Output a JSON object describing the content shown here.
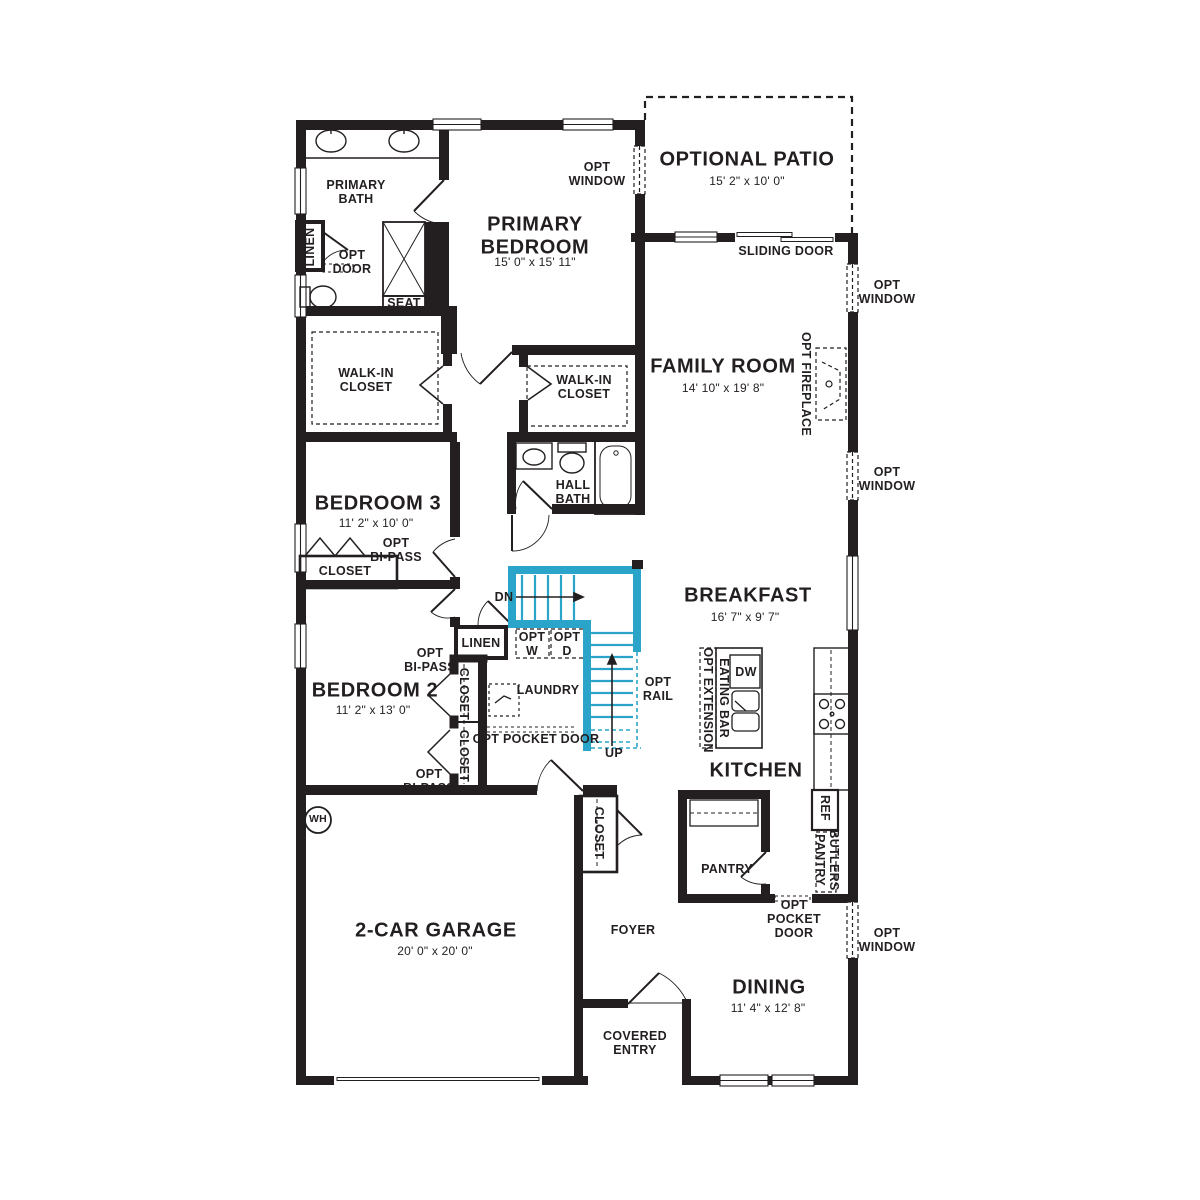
{
  "plan": {
    "title": "First floor residential floor plan",
    "colors": {
      "wall": "#231f20",
      "stairs_accent": "#2aa5c9",
      "background": "#ffffff"
    },
    "fixtures": [
      "double-vanity-sinks",
      "toilet",
      "shower-with-seat",
      "linen-cabinet",
      "bathtub",
      "vanity-sink",
      "walk-in-closet-shelving",
      "washer-optional",
      "dryer-optional",
      "laundry-sink",
      "kitchen-island",
      "dishwasher",
      "double-basin-sink",
      "range-burners",
      "refrigerator",
      "butlers-pantry-counter",
      "pantry-shelf",
      "fireplace-optional",
      "water-heater",
      "stairs-up",
      "stairs-down",
      "garage-door",
      "sliding-glass-door",
      "front-door"
    ],
    "labels": [
      {
        "id": "primary-bath",
        "lines": [
          "PRIMARY",
          "BATH"
        ],
        "x": 356,
        "y": 192,
        "cls": "sub"
      },
      {
        "id": "linen-bath",
        "lines": [
          "LINEN"
        ],
        "x": 310,
        "y": 247,
        "cls": "sub",
        "rot": -90
      },
      {
        "id": "opt-door",
        "lines": [
          "OPT",
          "DOOR"
        ],
        "x": 352,
        "y": 262,
        "cls": "sub"
      },
      {
        "id": "seat",
        "lines": [
          "SEAT"
        ],
        "x": 404,
        "y": 303,
        "cls": "sub"
      },
      {
        "id": "primary-bedroom-name",
        "lines": [
          "PRIMARY",
          "BEDROOM"
        ],
        "x": 535,
        "y": 236,
        "cls": "room"
      },
      {
        "id": "primary-bedroom-dims",
        "lines": [
          "15' 0\" x 15' 11\""
        ],
        "x": 535,
        "y": 263,
        "cls": "dim"
      },
      {
        "id": "opt-window-top",
        "lines": [
          "OPT",
          "WINDOW"
        ],
        "x": 597,
        "y": 174,
        "cls": "sub"
      },
      {
        "id": "optional-patio-name",
        "lines": [
          "OPTIONAL PATIO"
        ],
        "x": 747,
        "y": 160,
        "cls": "room"
      },
      {
        "id": "optional-patio-dims",
        "lines": [
          "15' 2\" x 10' 0\""
        ],
        "x": 747,
        "y": 182,
        "cls": "dim"
      },
      {
        "id": "sliding-door",
        "lines": [
          "SLIDING DOOR"
        ],
        "x": 786,
        "y": 251,
        "cls": "sub"
      },
      {
        "id": "opt-window-right-1",
        "lines": [
          "OPT",
          "WINDOW"
        ],
        "x": 887,
        "y": 292,
        "cls": "sub"
      },
      {
        "id": "family-room-name",
        "lines": [
          "FAMILY ROOM"
        ],
        "x": 723,
        "y": 367,
        "cls": "room"
      },
      {
        "id": "family-room-dims",
        "lines": [
          "14' 10\" x 19' 8\""
        ],
        "x": 723,
        "y": 389,
        "cls": "dim"
      },
      {
        "id": "opt-fireplace",
        "lines": [
          "OPT FIREPLACE"
        ],
        "x": 806,
        "y": 384,
        "cls": "sub",
        "rot": 90
      },
      {
        "id": "opt-window-right-2",
        "lines": [
          "OPT",
          "WINDOW"
        ],
        "x": 887,
        "y": 479,
        "cls": "sub"
      },
      {
        "id": "walk-in-closet-left",
        "lines": [
          "WALK-IN",
          "CLOSET"
        ],
        "x": 366,
        "y": 380,
        "cls": "sub"
      },
      {
        "id": "walk-in-closet-right",
        "lines": [
          "WALK-IN",
          "CLOSET"
        ],
        "x": 584,
        "y": 387,
        "cls": "sub"
      },
      {
        "id": "hall-bath",
        "lines": [
          "HALL",
          "BATH"
        ],
        "x": 573,
        "y": 492,
        "cls": "sub"
      },
      {
        "id": "bedroom3-name",
        "lines": [
          "BEDROOM 3"
        ],
        "x": 378,
        "y": 504,
        "cls": "room"
      },
      {
        "id": "bedroom3-dims",
        "lines": [
          "11' 2\" x 10' 0\""
        ],
        "x": 376,
        "y": 524,
        "cls": "dim"
      },
      {
        "id": "opt-bipass-bedroom3",
        "lines": [
          "OPT",
          "BI-PASS"
        ],
        "x": 396,
        "y": 550,
        "cls": "sub"
      },
      {
        "id": "closet-bedroom3",
        "lines": [
          "CLOSET"
        ],
        "x": 345,
        "y": 571,
        "cls": "sub"
      },
      {
        "id": "dn",
        "lines": [
          "DN"
        ],
        "x": 504,
        "y": 597,
        "cls": "sub"
      },
      {
        "id": "breakfast-name",
        "lines": [
          "BREAKFAST"
        ],
        "x": 748,
        "y": 596,
        "cls": "room"
      },
      {
        "id": "breakfast-dims",
        "lines": [
          "16' 7\" x 9' 7\""
        ],
        "x": 745,
        "y": 618,
        "cls": "dim"
      },
      {
        "id": "linen-stairs",
        "lines": [
          "LINEN"
        ],
        "x": 481,
        "y": 643,
        "cls": "sub"
      },
      {
        "id": "opt-w",
        "lines": [
          "OPT",
          "W"
        ],
        "x": 532,
        "y": 644,
        "cls": "sub"
      },
      {
        "id": "opt-d",
        "lines": [
          "OPT",
          "D"
        ],
        "x": 567,
        "y": 644,
        "cls": "sub"
      },
      {
        "id": "opt-bipass-bedroom2-top",
        "lines": [
          "OPT",
          "BI-PASS"
        ],
        "x": 430,
        "y": 660,
        "cls": "sub"
      },
      {
        "id": "closet-bedroom2-a",
        "lines": [
          "CLOSET"
        ],
        "x": 464,
        "y": 694,
        "cls": "sub",
        "rot": 90
      },
      {
        "id": "closet-bedroom2-b",
        "lines": [
          "CLOSET"
        ],
        "x": 464,
        "y": 756,
        "cls": "sub",
        "rot": 90
      },
      {
        "id": "bedroom2-name",
        "lines": [
          "BEDROOM 2"
        ],
        "x": 375,
        "y": 691,
        "cls": "room"
      },
      {
        "id": "bedroom2-dims",
        "lines": [
          "11' 2\" x 13' 0\""
        ],
        "x": 373,
        "y": 711,
        "cls": "dim"
      },
      {
        "id": "laundry",
        "lines": [
          "LAUNDRY"
        ],
        "x": 548,
        "y": 690,
        "cls": "sub"
      },
      {
        "id": "opt-rail",
        "lines": [
          "OPT",
          "RAIL"
        ],
        "x": 658,
        "y": 689,
        "cls": "sub"
      },
      {
        "id": "opt-pocket-door-laundry",
        "lines": [
          "OPT POCKET DOOR"
        ],
        "x": 536,
        "y": 739,
        "cls": "sub"
      },
      {
        "id": "up",
        "lines": [
          "UP"
        ],
        "x": 614,
        "y": 753,
        "cls": "sub"
      },
      {
        "id": "opt-bipass-bedroom2-bottom",
        "lines": [
          "OPT",
          "BI-PASS"
        ],
        "x": 429,
        "y": 781,
        "cls": "sub"
      },
      {
        "id": "eating-bar",
        "lines": [
          "EATING BAR"
        ],
        "x": 724,
        "y": 698,
        "cls": "sub",
        "rot": 90
      },
      {
        "id": "opt-extension",
        "lines": [
          "OPT EXTENSION"
        ],
        "x": 708,
        "y": 700,
        "cls": "sub",
        "rot": 90
      },
      {
        "id": "dw",
        "lines": [
          "DW"
        ],
        "x": 746,
        "y": 672,
        "cls": "sub"
      },
      {
        "id": "kitchen-name",
        "lines": [
          "KITCHEN"
        ],
        "x": 756,
        "y": 771,
        "cls": "room"
      },
      {
        "id": "wh",
        "lines": [
          "WH"
        ],
        "x": 318,
        "y": 820,
        "cls": "small"
      },
      {
        "id": "ref",
        "lines": [
          "REF"
        ],
        "x": 825,
        "y": 808,
        "cls": "sub",
        "rot": 90
      },
      {
        "id": "butlers-pantry",
        "lines": [
          "BUTLERS",
          "PANTRY"
        ],
        "x": 827,
        "y": 860,
        "cls": "sub",
        "rot": 90
      },
      {
        "id": "pantry",
        "lines": [
          "PANTRY"
        ],
        "x": 727,
        "y": 869,
        "cls": "sub"
      },
      {
        "id": "opt-pocket-door-kitchen",
        "lines": [
          "OPT",
          "POCKET",
          "DOOR"
        ],
        "x": 794,
        "y": 919,
        "cls": "sub"
      },
      {
        "id": "opt-window-right-3",
        "lines": [
          "OPT",
          "WINDOW"
        ],
        "x": 887,
        "y": 940,
        "cls": "sub"
      },
      {
        "id": "foyer",
        "lines": [
          "FOYER"
        ],
        "x": 633,
        "y": 930,
        "cls": "sub"
      },
      {
        "id": "closet-foyer",
        "lines": [
          "CLOSET"
        ],
        "x": 599,
        "y": 833,
        "cls": "sub",
        "rot": 90
      },
      {
        "id": "garage-name",
        "lines": [
          "2-CAR GARAGE"
        ],
        "x": 436,
        "y": 931,
        "cls": "room"
      },
      {
        "id": "garage-dims",
        "lines": [
          "20' 0\" x 20' 0\""
        ],
        "x": 435,
        "y": 952,
        "cls": "dim"
      },
      {
        "id": "dining-name",
        "lines": [
          "DINING"
        ],
        "x": 769,
        "y": 988,
        "cls": "room"
      },
      {
        "id": "dining-dims",
        "lines": [
          "11' 4\" x 12' 8\""
        ],
        "x": 768,
        "y": 1009,
        "cls": "dim"
      },
      {
        "id": "covered-entry",
        "lines": [
          "COVERED",
          "ENTRY"
        ],
        "x": 635,
        "y": 1043,
        "cls": "sub"
      }
    ]
  }
}
